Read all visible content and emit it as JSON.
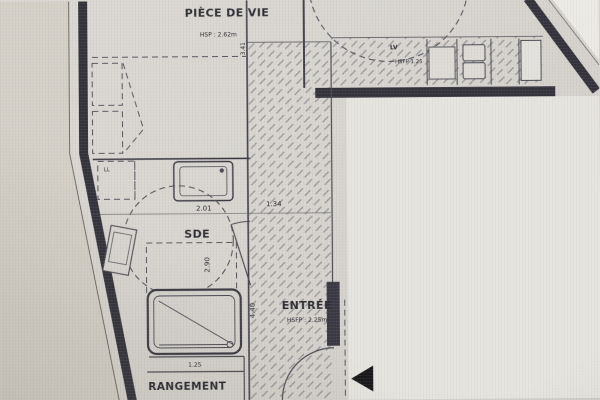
{
  "plan": {
    "rooms": [
      {
        "id": "piece-de-vie",
        "label": "PIÈCE DE VIE",
        "ceiling_note": "HSP : 2.62m"
      },
      {
        "id": "sde",
        "label": "SDE"
      },
      {
        "id": "entree",
        "label": "ENTRÉE",
        "ceiling_note": "HSFP : 2.25m"
      },
      {
        "id": "rangement",
        "label": "RANGEMENT"
      }
    ],
    "appliances": [
      {
        "id": "lv",
        "label": "LV",
        "note": "HSFP 1.25"
      },
      {
        "id": "ll",
        "label": "LL"
      }
    ],
    "dimensions": [
      {
        "id": "dim-3-41",
        "value": "3.41",
        "orientation": "vertical"
      },
      {
        "id": "dim-2-01",
        "value": "2.01",
        "orientation": "horizontal"
      },
      {
        "id": "dim-1-34",
        "value": "1.34",
        "orientation": "horizontal"
      },
      {
        "id": "dim-2-90",
        "value": "2.90",
        "orientation": "vertical"
      },
      {
        "id": "dim-4-40",
        "value": "4.40",
        "orientation": "vertical"
      },
      {
        "id": "dim-1-25",
        "value": "1.25",
        "orientation": "horizontal"
      }
    ],
    "icons": [
      {
        "name": "entrance-arrow-icon",
        "meaning": "main entrance direction",
        "glyph": "◀"
      }
    ],
    "colors": {
      "wall": "#33323a",
      "line": "#4a4a52",
      "paper": "#d8d5d0",
      "exterior_right": "#e6e4df",
      "exterior_left": "#d4d0c7",
      "arrow": "#17171a"
    }
  }
}
